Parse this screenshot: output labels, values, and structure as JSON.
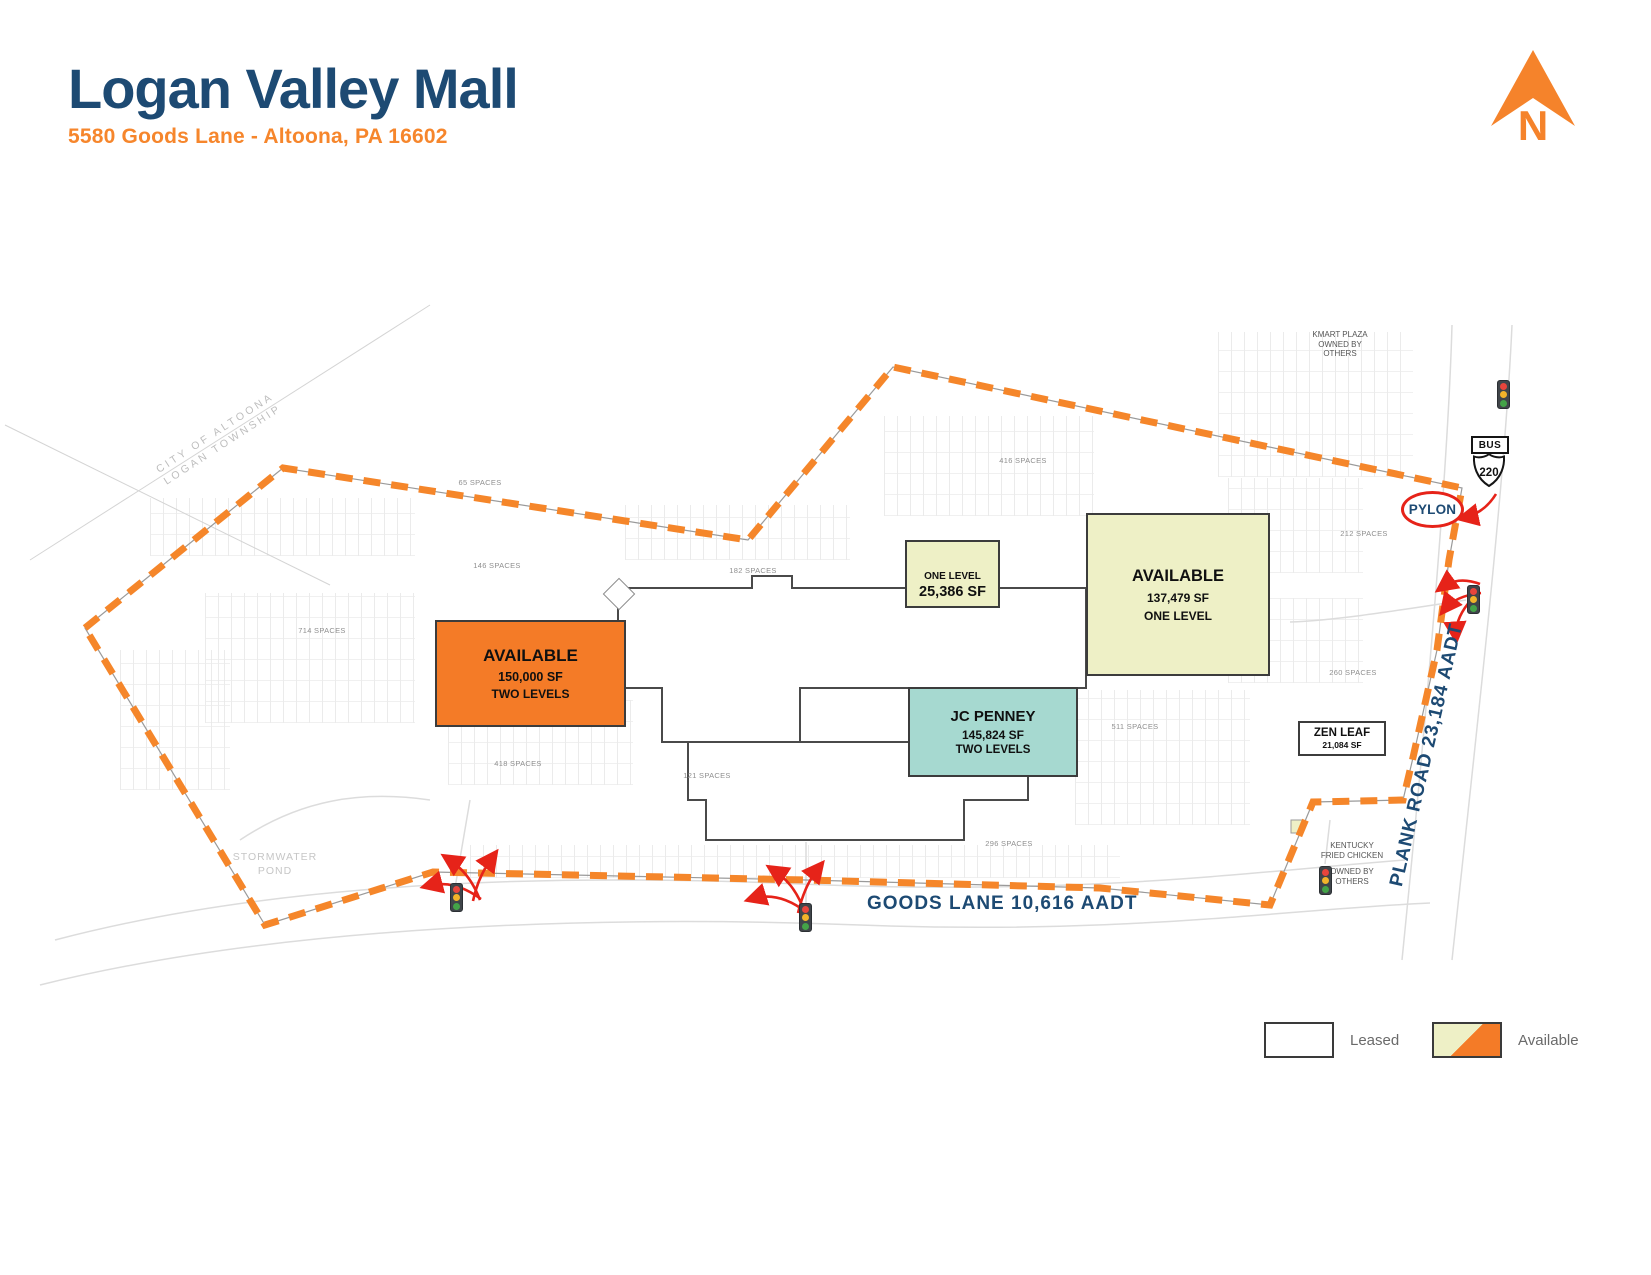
{
  "header": {
    "title": "Logan Valley Mall",
    "subtitle": "5580 Goods Lane - Altoona, PA 16602"
  },
  "compass": {
    "label": "N"
  },
  "buildings": {
    "west_anchor": {
      "name": "AVAILABLE",
      "size": "150,000 SF",
      "levels": "TWO LEVELS"
    },
    "north_shop": {
      "name": "ONE LEVEL",
      "size": "25,386 SF"
    },
    "east_anchor": {
      "name": "AVAILABLE",
      "size": "137,479 SF",
      "levels": "ONE LEVEL"
    },
    "jc_penney": {
      "name": "JC PENNEY",
      "size": "145,824 SF",
      "levels": "TWO LEVELS"
    },
    "zen_leaf": {
      "name": "ZEN LEAF",
      "size": "21,084 SF"
    }
  },
  "outparcels": {
    "kmart_plaza": [
      "KMART PLAZA",
      "OWNED BY",
      "OTHERS"
    ],
    "kfc": [
      "KENTUCKY",
      "FRIED CHICKEN",
      "OWNED BY",
      "OTHERS"
    ]
  },
  "roads": {
    "goods_lane": "GOODS LANE 10,616 AADT",
    "plank_road": "PLANK ROAD 23,184 AADT"
  },
  "signs": {
    "bus": "BUS",
    "route_number": "220",
    "pylon": "PYLON"
  },
  "area_labels": {
    "municipality": [
      "CITY OF ALTOONA",
      "LOGAN TOWNSHIP"
    ],
    "pond": [
      "STORMWATER",
      "POND"
    ]
  },
  "parking_labels": [
    "65 SPACES",
    "146 SPACES",
    "182 SPACES",
    "416 SPACES",
    "714 SPACES",
    "418 SPACES",
    "121 SPACES",
    "296 SPACES",
    "212 SPACES",
    "260 SPACES",
    "511 SPACES"
  ],
  "legend": {
    "leased": "Leased",
    "available": "Available"
  },
  "colors": {
    "navy": "#1d4a73",
    "accent_orange": "#f6862c",
    "available_orange": "#f47b27",
    "available_pale": "#eef0c6",
    "jcpenney_teal": "#a6d9d0",
    "boundary_orange": "#f5862a",
    "arrow_red": "#e62319"
  }
}
